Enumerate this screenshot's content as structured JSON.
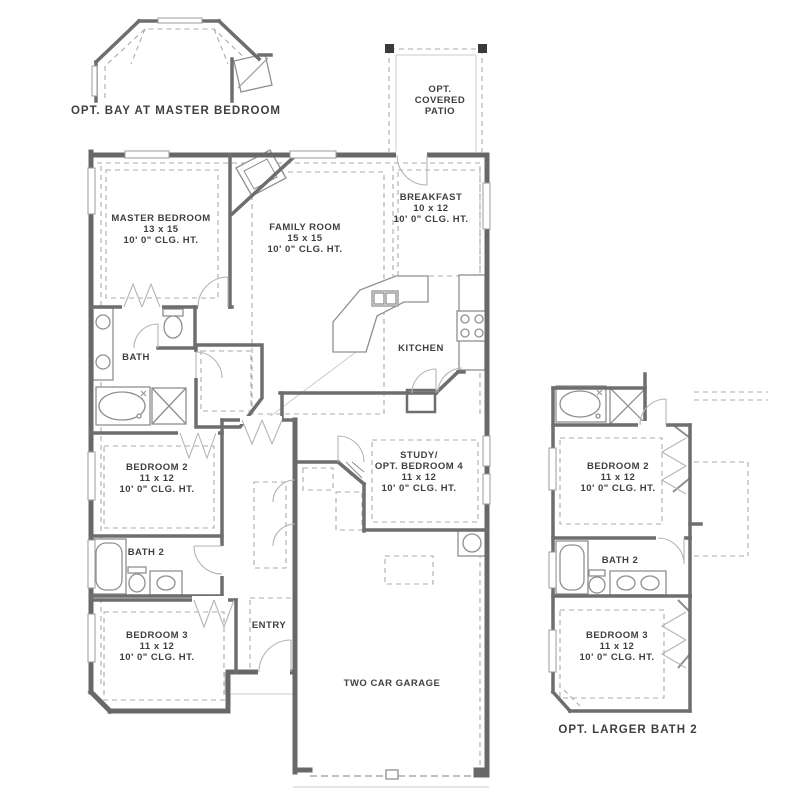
{
  "colors": {
    "wall": "#686868",
    "text": "#3f3f3f",
    "dash": "#ababab",
    "fixture": "#8f8f8f",
    "door_arc": "#b5b5b5",
    "background": "#ffffff"
  },
  "captions": {
    "bay": "OPT. BAY AT MASTER BEDROOM",
    "larger_bath2": "OPT. LARGER BATH 2"
  },
  "rooms": {
    "patio": {
      "line1": "OPT.",
      "line2": "COVERED",
      "line3": "PATIO"
    },
    "master": {
      "name": "MASTER BEDROOM",
      "dims": "13 x 15",
      "ceiling": "10' 0\" CLG. HT."
    },
    "family": {
      "name": "FAMILY ROOM",
      "dims": "15 x 15",
      "ceiling": "10' 0\" CLG. HT."
    },
    "breakfast": {
      "name": "BREAKFAST",
      "dims": "10 x 12",
      "ceiling": "10' 0\" CLG. HT."
    },
    "kitchen": {
      "name": "KITCHEN"
    },
    "bath": {
      "name": "BATH"
    },
    "bedroom2": {
      "name": "BEDROOM 2",
      "dims": "11 x 12",
      "ceiling": "10' 0\" CLG. HT."
    },
    "bath2": {
      "name": "BATH 2"
    },
    "study": {
      "line1": "STUDY/",
      "line2": "OPT. BEDROOM 4",
      "dims": "11 x 12",
      "ceiling": "10' 0\" CLG. HT."
    },
    "bedroom3": {
      "name": "BEDROOM 3",
      "dims": "11 x 12",
      "ceiling": "10' 0\" CLG. HT."
    },
    "entry": {
      "name": "ENTRY"
    },
    "garage": {
      "name": "TWO CAR GARAGE"
    }
  },
  "inset_larger_bath2": {
    "bedroom2": {
      "name": "BEDROOM 2",
      "dims": "11 x 12",
      "ceiling": "10' 0\" CLG. HT."
    },
    "bath2": {
      "name": "BATH 2"
    },
    "bedroom3": {
      "name": "BEDROOM 3",
      "dims": "11 x 12",
      "ceiling": "10' 0\" CLG. HT."
    }
  }
}
